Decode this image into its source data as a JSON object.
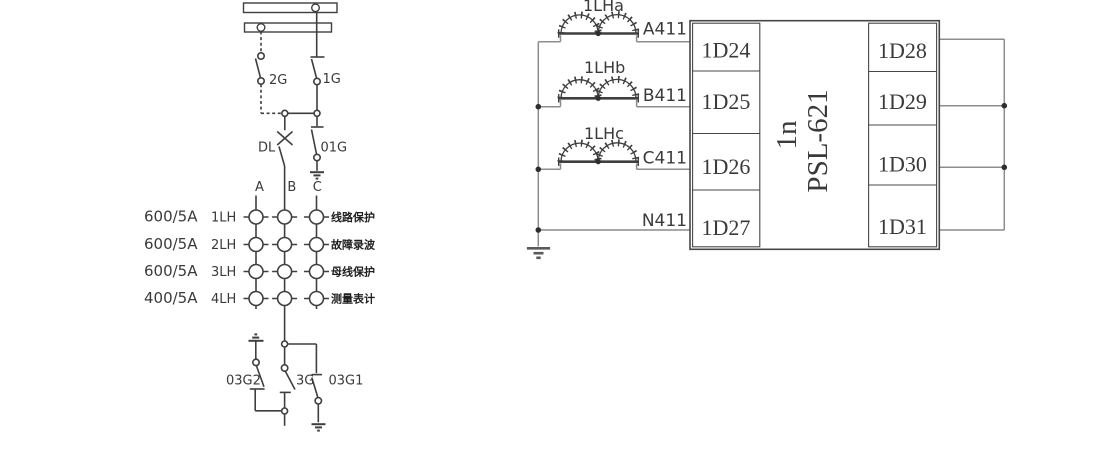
{
  "colors": {
    "line": "#3f3f3f",
    "wire": "#8c8c8c",
    "text": "#3a3a3a",
    "cn_text": "#1f1f1f",
    "background": "#ffffff"
  },
  "left_diagram": {
    "switch_labels": {
      "g2": "2G",
      "g1": "1G",
      "dl": "DL",
      "g01": "01G",
      "g03_2": "03G2",
      "g3": "3G",
      "g03_1": "03G1"
    },
    "phases": [
      "A",
      "B",
      "C"
    ],
    "ct_rows": [
      {
        "ratio": "600/5A",
        "name": "1LH",
        "purpose": "线路保护"
      },
      {
        "ratio": "600/5A",
        "name": "2LH",
        "purpose": "故障录波"
      },
      {
        "ratio": "600/5A",
        "name": "3LH",
        "purpose": "母线保护"
      },
      {
        "ratio": "400/5A",
        "name": "4LH",
        "purpose": "测量表计"
      }
    ]
  },
  "right_diagram": {
    "ct_labels": [
      "1LHa",
      "1LHb",
      "1LHc"
    ],
    "wire_labels": [
      "A411",
      "B411",
      "C411",
      "N411"
    ],
    "terminals_left": [
      "1D24",
      "1D25",
      "1D26",
      "1D27"
    ],
    "terminals_right": [
      "1D28",
      "1D29",
      "1D30",
      "1D31"
    ],
    "relay": {
      "designation": "1n",
      "model": "PSL-621"
    }
  }
}
